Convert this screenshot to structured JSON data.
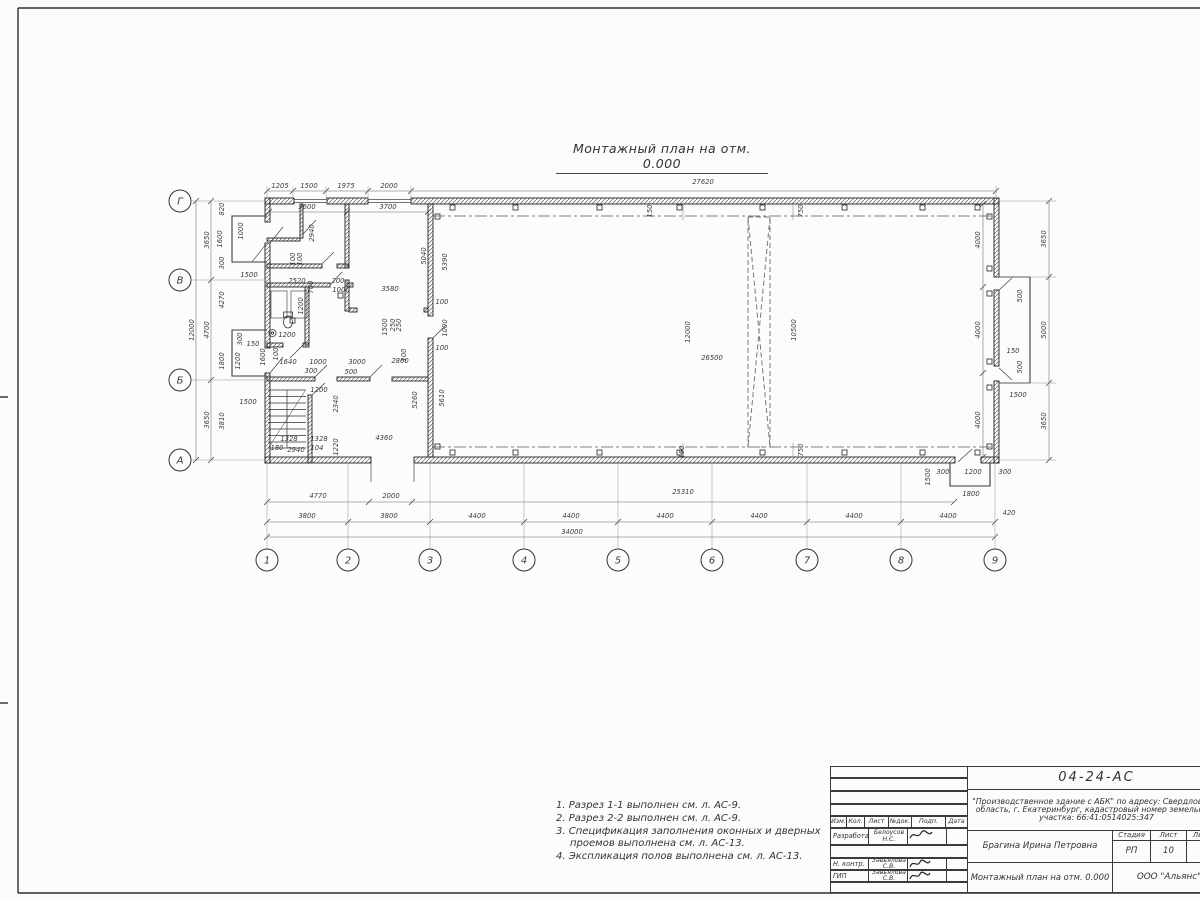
{
  "title": "Монтажный план на отм. 0.000",
  "notes": {
    "items": [
      "1. Разрез 1-1 выполнен см. л. АС-9.",
      "2. Разрез 2-2 выполнен см. л. АС-9.",
      "3. Спецификация заполнения оконных и дверных",
      "проемов выполнена см. л. АС-13.",
      "4. Экспликация полов выполнена см. л. АС-13."
    ]
  },
  "stamp": {
    "doc_code": "04-24-АС",
    "project_line1": "\"Производственное здание с АБК\" по адресу: Свердловская",
    "project_line2": "область, г. Екатеринбург, кадастровый номер земельного",
    "project_line3": "участка: 66:41:0514025:347",
    "header_cols": [
      "Изм.",
      "Кол.",
      "Лист",
      "№док.",
      "Подп.",
      "Дата"
    ],
    "role1": "Разработал",
    "name1": "Белоусов Н.С.",
    "role2": "Н. контр.",
    "name2": "Завьялова С.В.",
    "role3": "ГИП",
    "name3": "Завьялова С.В.",
    "author": "Брагина Ирина Петровна",
    "stage_label": "Стадия",
    "sheet_label": "Лист",
    "sheets_label": "Листов",
    "stage": "РП",
    "sheet_no": "10",
    "sheets_total": "13",
    "drawing_title": "Монтажный план на отм. 0.000",
    "org": "ООО \"Альянс\""
  },
  "plan": {
    "grid_cols": [
      "1",
      "2",
      "3",
      "4",
      "5",
      "6",
      "7",
      "8",
      "9"
    ],
    "grid_rows": [
      "Г",
      "В",
      "Б",
      "А"
    ],
    "dims": {
      "top1": [
        "1205",
        "1500",
        "1975",
        "2000",
        "27620"
      ],
      "top2": [
        "3600",
        "3700"
      ],
      "bot1": [
        "4770",
        "2000",
        "25310"
      ],
      "bot2": [
        "3800",
        "3800",
        "4400",
        "4400",
        "4400",
        "4400",
        "4400",
        "4400"
      ],
      "bot3": [
        "34000"
      ],
      "left1": [
        "12000"
      ],
      "left2": [
        "3650",
        "4700",
        "3650"
      ],
      "left3": [
        "820",
        "1600",
        "300",
        "1500",
        "1000",
        "4270",
        "300",
        "1200",
        "150",
        "1800",
        "1500",
        "3810"
      ],
      "right1": [
        "4000",
        "4000",
        "4000"
      ],
      "right2": [
        "3650",
        "5000",
        "3650"
      ],
      "right3": [
        "500",
        "500",
        "150",
        "1500"
      ],
      "hall": [
        "150",
        "750",
        "12000",
        "26500",
        "10500",
        "750",
        "150",
        "5040",
        "5390",
        "5260",
        "5610",
        "100",
        "1000",
        "100"
      ],
      "abk": [
        "2940",
        "100",
        "100",
        "2520",
        "700",
        "200",
        "1000",
        "3580",
        "1200",
        "1200",
        "1640",
        "100",
        "1600",
        "1000",
        "300",
        "3000",
        "500",
        "2860",
        "1500",
        "250",
        "250",
        "100"
      ],
      "stair": [
        "1200",
        "2340",
        "1328",
        "1328",
        "180",
        "2940",
        "104",
        "1220",
        "4360"
      ],
      "porch": [
        "1500",
        "300",
        "1200",
        "300",
        "1800",
        "420"
      ]
    }
  }
}
